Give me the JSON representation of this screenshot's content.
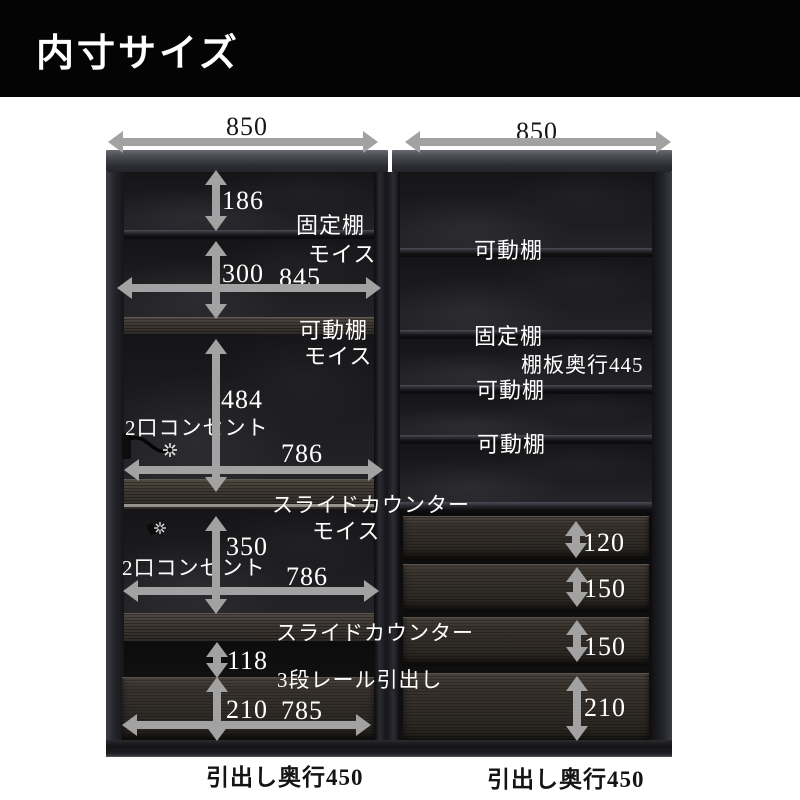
{
  "header": {
    "title": "内寸サイズ"
  },
  "colors": {
    "arrow": "#a2a2a2",
    "header_bg": "#040404",
    "label_light": "#ffffff",
    "label_dark": "#161616"
  },
  "annotations": {
    "top_numbers": [
      {
        "name": "dim-850-left",
        "text": "850",
        "x": 226,
        "y": 112
      },
      {
        "name": "dim-850-right",
        "text": "850",
        "x": 516,
        "y": 117
      }
    ],
    "dimension_numbers": [
      {
        "name": "dim-186",
        "text": "186",
        "x": 222,
        "y": 186
      },
      {
        "name": "dim-300",
        "text": "300",
        "x": 222,
        "y": 259
      },
      {
        "name": "dim-845",
        "text": "845",
        "x": 279,
        "y": 263
      },
      {
        "name": "dim-484",
        "text": "484",
        "x": 221,
        "y": 385
      },
      {
        "name": "dim-786-upper",
        "text": "786",
        "x": 281,
        "y": 439
      },
      {
        "name": "dim-350",
        "text": "350",
        "x": 226,
        "y": 532
      },
      {
        "name": "dim-786-lower",
        "text": "786",
        "x": 286,
        "y": 562
      },
      {
        "name": "dim-118",
        "text": "118",
        "x": 227,
        "y": 646
      },
      {
        "name": "dim-210-left",
        "text": "210",
        "x": 226,
        "y": 695
      },
      {
        "name": "dim-785",
        "text": "785",
        "x": 281,
        "y": 696
      },
      {
        "name": "dim-120",
        "text": "120",
        "x": 583,
        "y": 528
      },
      {
        "name": "dim-150-upper",
        "text": "150",
        "x": 584,
        "y": 574
      },
      {
        "name": "dim-150-lower",
        "text": "150",
        "x": 584,
        "y": 632
      },
      {
        "name": "dim-210-right",
        "text": "210",
        "x": 584,
        "y": 693
      }
    ],
    "part_labels": [
      {
        "name": "label-fixed-shelf-left",
        "text": "固定棚",
        "x": 296,
        "y": 208,
        "fs": 22
      },
      {
        "name": "label-moiss-1",
        "text": "モイス",
        "x": 308,
        "y": 237,
        "fs": 22
      },
      {
        "name": "label-movable-shelf-left",
        "text": "可動棚",
        "x": 299,
        "y": 313,
        "fs": 22
      },
      {
        "name": "label-moiss-2",
        "text": "モイス",
        "x": 304,
        "y": 339,
        "fs": 22
      },
      {
        "name": "label-outlet-upper",
        "text": "2口コンセント",
        "x": 125,
        "y": 412,
        "fs": 21
      },
      {
        "name": "label-slide-counter-upper",
        "text": "スライドカウンター",
        "x": 272,
        "y": 489,
        "fs": 21
      },
      {
        "name": "label-moiss-3",
        "text": "モイス",
        "x": 312,
        "y": 514,
        "fs": 22
      },
      {
        "name": "label-outlet-lower",
        "text": "2口コンセント",
        "x": 122,
        "y": 552,
        "fs": 21
      },
      {
        "name": "label-slide-counter-lower",
        "text": "スライドカウンター",
        "x": 276,
        "y": 617,
        "fs": 21
      },
      {
        "name": "label-3-rail-drawer",
        "text": "3段レール引出し",
        "x": 277,
        "y": 664,
        "fs": 21
      },
      {
        "name": "label-movable-shelf-r1",
        "text": "可動棚",
        "x": 474,
        "y": 233,
        "fs": 22
      },
      {
        "name": "label-fixed-shelf-right",
        "text": "固定棚",
        "x": 474,
        "y": 319,
        "fs": 22
      },
      {
        "name": "label-shelf-depth-445",
        "text": "棚板奥行445",
        "x": 521,
        "y": 349,
        "fs": 21
      },
      {
        "name": "label-movable-shelf-r2",
        "text": "可動棚",
        "x": 476,
        "y": 373,
        "fs": 22
      },
      {
        "name": "label-movable-shelf-r3",
        "text": "可動棚",
        "x": 477,
        "y": 427,
        "fs": 22
      }
    ],
    "footer_labels": [
      {
        "name": "label-drawer-depth-left",
        "text": "引出し奥行450",
        "x": 206,
        "y": 758
      },
      {
        "name": "label-drawer-depth-right",
        "text": "引出し奥行450",
        "x": 487,
        "y": 760
      }
    ]
  },
  "arrows": {
    "vertical": [
      {
        "name": "arrow-186",
        "x": 216,
        "y1": 170,
        "y2": 231
      },
      {
        "name": "arrow-300",
        "x": 216,
        "y1": 241,
        "y2": 319
      },
      {
        "name": "arrow-484",
        "x": 216,
        "y1": 339,
        "y2": 492
      },
      {
        "name": "arrow-350",
        "x": 216,
        "y1": 516,
        "y2": 614
      },
      {
        "name": "arrow-118",
        "x": 217,
        "y1": 642,
        "y2": 678
      },
      {
        "name": "arrow-210-left",
        "x": 217,
        "y1": 677,
        "y2": 741
      },
      {
        "name": "arrow-120",
        "x": 576,
        "y1": 521,
        "y2": 558
      },
      {
        "name": "arrow-150-upper",
        "x": 577,
        "y1": 567,
        "y2": 607
      },
      {
        "name": "arrow-150-lower",
        "x": 577,
        "y1": 620,
        "y2": 662
      },
      {
        "name": "arrow-210-right",
        "x": 577,
        "y1": 676,
        "y2": 741
      }
    ],
    "horizontal": [
      {
        "name": "arrow-850-left",
        "y": 142,
        "x1": 108,
        "x2": 378
      },
      {
        "name": "arrow-850-right",
        "y": 142,
        "x1": 405,
        "x2": 671
      },
      {
        "name": "arrow-845",
        "y": 288,
        "x1": 117,
        "x2": 381
      },
      {
        "name": "arrow-786-upper",
        "y": 470,
        "x1": 124,
        "x2": 383
      },
      {
        "name": "arrow-786-lower",
        "y": 591,
        "x1": 123,
        "x2": 379
      },
      {
        "name": "arrow-785",
        "y": 725,
        "x1": 122,
        "x2": 371
      }
    ]
  }
}
